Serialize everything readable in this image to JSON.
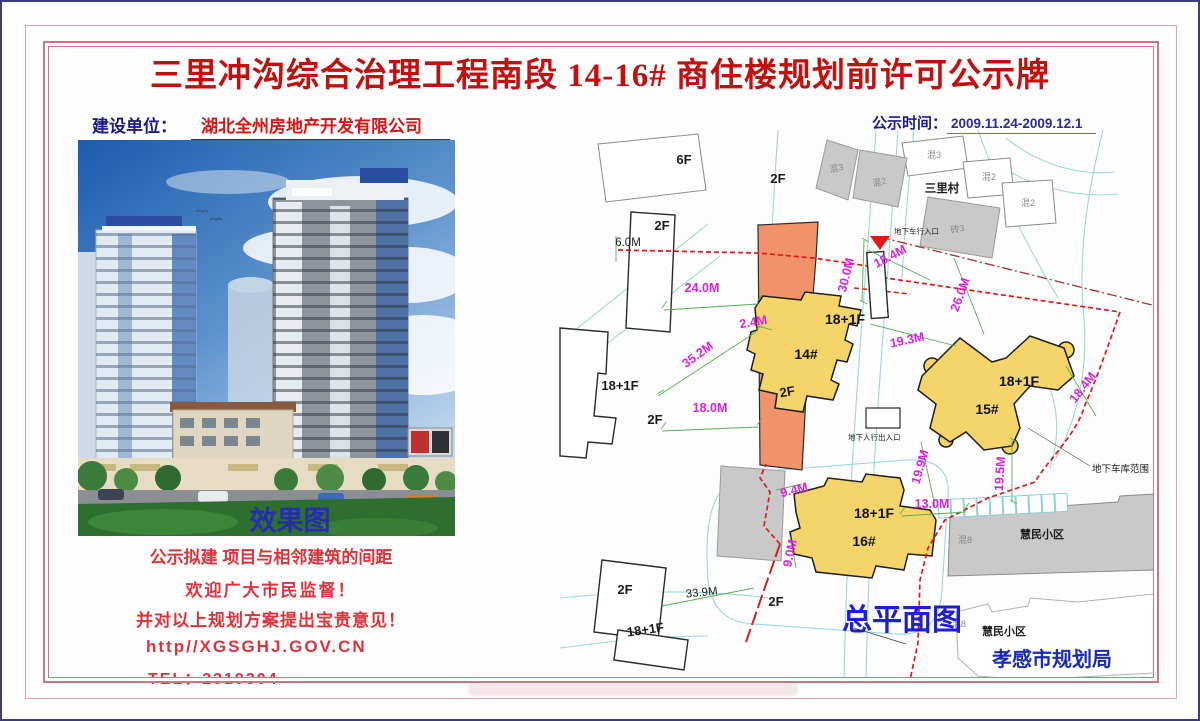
{
  "page": {
    "title": "三里冲沟综合治理工程南段 14-16# 商住楼规划前许可公示牌",
    "builder_label": "建设单位：",
    "builder_name": "湖北全州房地产开发有限公司",
    "publish_label": "公示时间：",
    "publish_value": "2009.11.24-2009.12.1"
  },
  "left": {
    "photo_caption": "效果图",
    "notes": [
      "公示拟建 项目与相邻建筑的间距",
      "欢迎广大市民监督！",
      "并对以上规划方案提出宝贵意见！",
      "http//XGSGHJ.GOV.CN",
      "TEL：2319304"
    ]
  },
  "plan": {
    "caption": "总平面图",
    "authority": "孝感市规划局",
    "village": "三里村",
    "estates": [
      "慧民小区",
      "慧民小区"
    ],
    "garage_zone": "地下车库范围",
    "vehicle_entry": "地下车行入口",
    "ped_entry": "地下人行出入口",
    "buildings": [
      {
        "no": "14#",
        "floors": "18+1F"
      },
      {
        "no": "15#",
        "floors": "18+1F"
      },
      {
        "no": "16#",
        "floors": "18+1F"
      }
    ],
    "neighbor_floors": [
      "6F",
      "2F",
      "2F",
      "18+1F",
      "2F",
      "2F",
      "2F",
      "2F",
      "18+1F"
    ],
    "struct_labels": [
      "混3",
      "混2",
      "混3",
      "混2",
      "混2",
      "砖3",
      "混8",
      "混8"
    ],
    "dims_magenta": [
      "24.0M",
      "2.4M",
      "35.2M",
      "18.0M",
      "30.0M",
      "18.4M",
      "26.0M",
      "19.3M",
      "18.4M",
      "19.9M",
      "19.5M",
      "9.4M",
      "13.0M",
      "9.0M"
    ],
    "dims_black": [
      "6.0M",
      "33.9M"
    ]
  },
  "colors": {
    "title_red": "#c40f0f",
    "navy": "#1a1a8c",
    "dim_magenta": "#e020e0",
    "building_yellow": "#f5d469",
    "podium_orange": "#f2926a",
    "boundary_red": "#e01818",
    "plan_blue": "#2020c8"
  }
}
